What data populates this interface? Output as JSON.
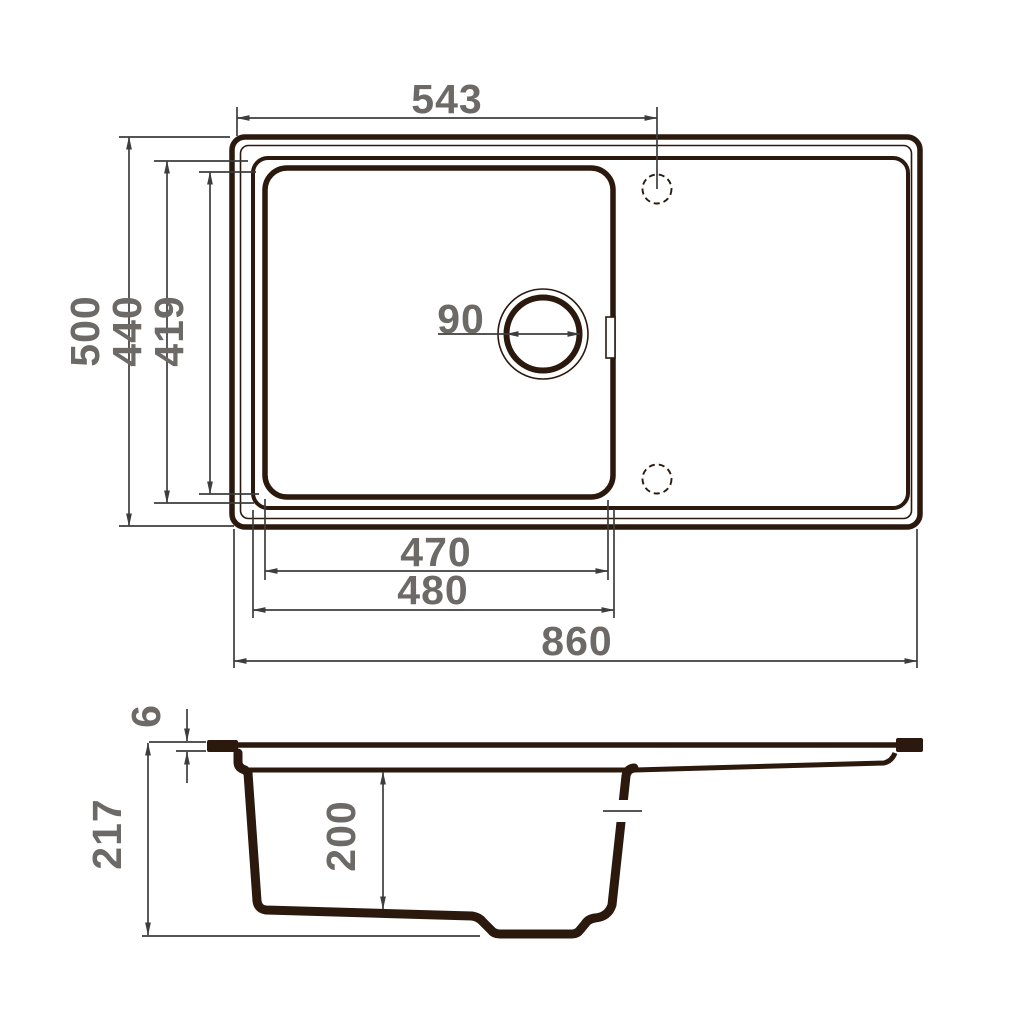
{
  "drawing": {
    "type": "sink-technical-drawing",
    "views": {
      "top_view": {
        "labels": {
          "faucet_offset": "543",
          "overall_depth": "500",
          "bowl_outer_depth": "440",
          "bowl_inner_depth": "419",
          "drain_diameter": "90",
          "bowl_inner_width": "470",
          "bowl_outer_width": "480",
          "overall_width": "860"
        }
      },
      "side_view": {
        "labels": {
          "rim_thickness": "6",
          "overall_height": "217",
          "bowl_depth": "200"
        }
      }
    },
    "colors": {
      "outline": "#2b190e",
      "dimension_line": "#3d3d3d",
      "dimension_text": "#6c6966",
      "background": "#ffffff"
    }
  }
}
